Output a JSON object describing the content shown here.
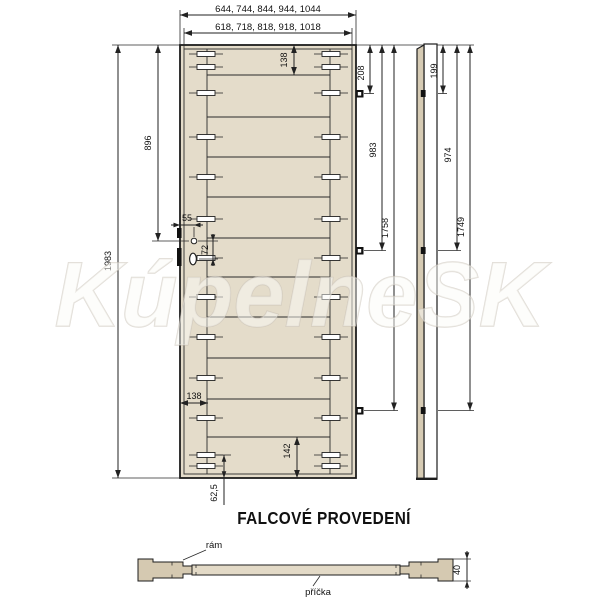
{
  "watermark": "KúpelneSK",
  "title": "FALCOVÉ PROVEDENÍ",
  "front": {
    "outer_widths": "644, 744, 844, 944, 1044",
    "inner_widths": "618, 718, 818, 918, 1018",
    "total_height": "1983",
    "lock_height": "896",
    "lock_edge_offset": "55",
    "lock_hole_spacing": "72",
    "top_rail_offset": "138",
    "stile_width": "138",
    "bottom_rail_height": "142",
    "bottom_dowel_offset": "62,5",
    "hinge_1_offset": "208",
    "hinge_2_offset": "983",
    "hinge_3_offset": "1758"
  },
  "side": {
    "hinge_1_offset": "199",
    "hinge_2_offset": "974",
    "hinge_3_offset": "1749"
  },
  "section": {
    "door_thickness": "40",
    "frame_label": "rám",
    "crossbar_label": "příčka"
  },
  "colors": {
    "door_fill": "#e4dcca",
    "side_strip_fill": "#d6cbb4",
    "frame_fill": "#d5c9b1",
    "board_fill": "#e3dac7",
    "line": "#222222"
  }
}
